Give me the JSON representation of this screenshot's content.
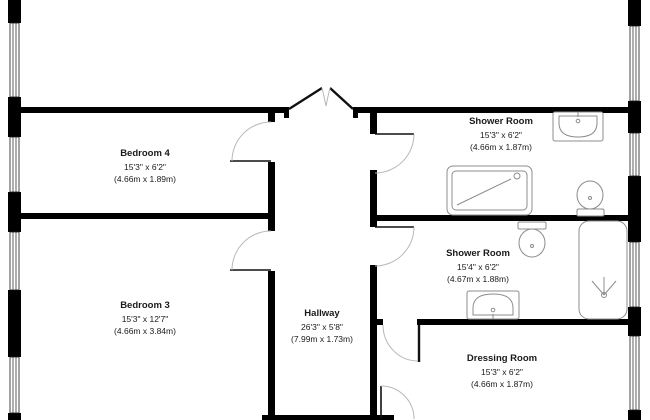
{
  "rooms": [
    {
      "name": "Bedroom 4",
      "size_ft": "15'3\" x 6'2\"",
      "size_m": "(4.66m x 1.89m)"
    },
    {
      "name": "Shower Room",
      "size_ft": "15'3\" x 6'2\"",
      "size_m": "(4.66m x 1.87m)"
    },
    {
      "name": "Bedroom 3",
      "size_ft": "15'3\" x 12'7\"",
      "size_m": "(4.66m x 3.84m)"
    },
    {
      "name": "Hallway",
      "size_ft": "26'3\" x 5'8\"",
      "size_m": "(7.99m x 1.73m)"
    },
    {
      "name": "Shower Room",
      "size_ft": "15'4\" x 6'2\"",
      "size_m": "(4.67m x 1.88m)"
    },
    {
      "name": "Dressing Room",
      "size_ft": "15'3\" x 6'2\"",
      "size_m": "(4.66m x 1.87m)"
    }
  ],
  "colors": {
    "wall": "#000000",
    "door_leaf": "#111111",
    "swing_arc": "#b8b8b8",
    "fixture_outline": "#8c8c8c",
    "text": "#1a1a1a",
    "background": "#ffffff"
  }
}
